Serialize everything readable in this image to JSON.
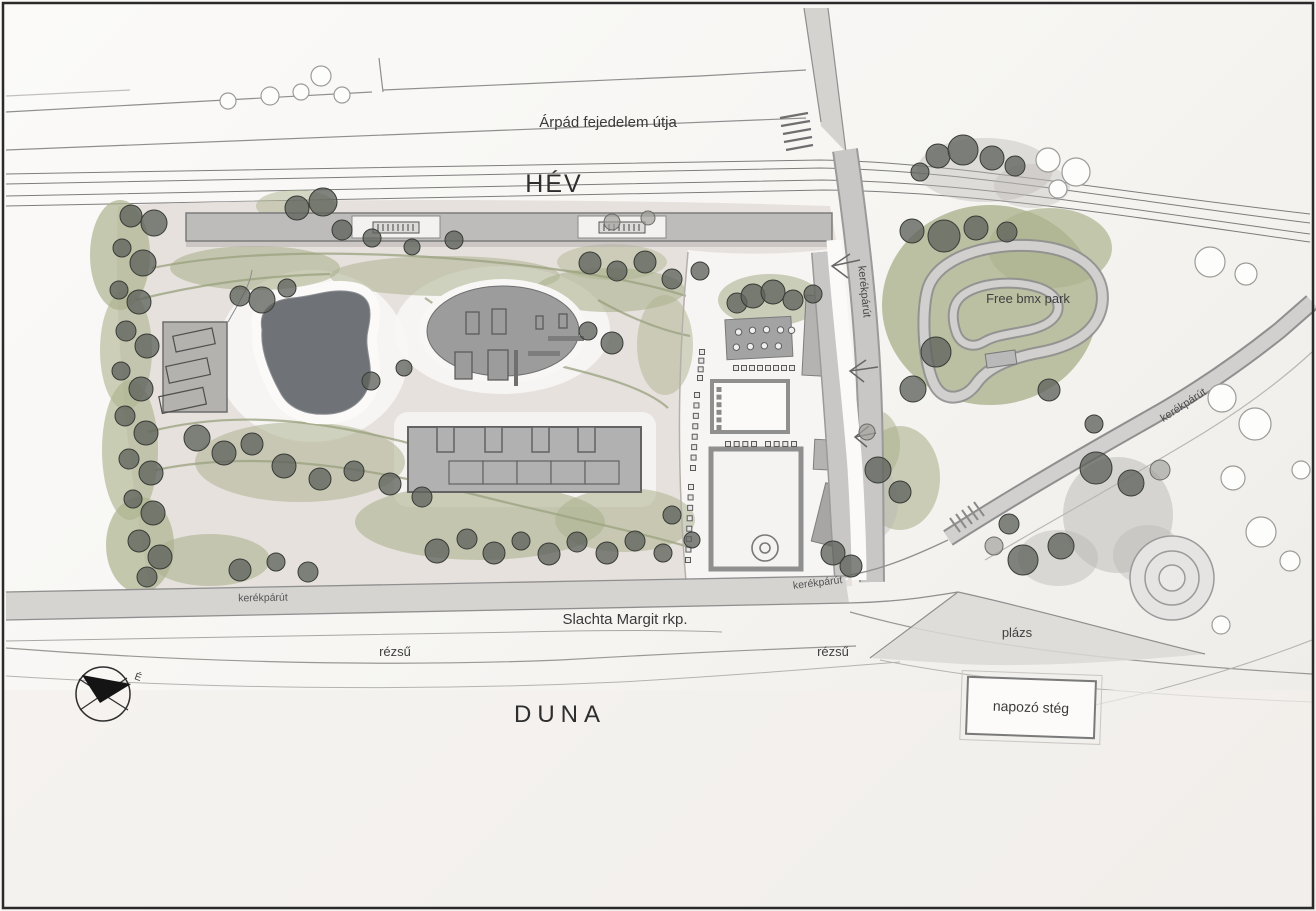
{
  "map": {
    "top": {
      "street": "Árpád fejedelem útja",
      "railway": "HÉV"
    },
    "park": {
      "bmx": "Free bmx park"
    },
    "paths": {
      "bike_vertical": "kerékpárút",
      "bike_diagonal": "kerékpárút",
      "bike_quay_left": "kerékpárút",
      "bike_quay_mid": "kerékpárút"
    },
    "waterfront": {
      "quay": "Slachta Margit rkp.",
      "embankment_left": "rézsű",
      "embankment_right": "rézsű",
      "beach": "plázs",
      "sun_deck": "napozó stég",
      "river": "DUNA"
    },
    "compass": {
      "north": "É"
    }
  },
  "colors": {
    "paper": "#f8f7f4",
    "ink": "#3a3a3a",
    "road_edge": "#8f8f8f",
    "building_gray": "#b3b2b0",
    "platform_gray": "#bdbcba",
    "pond_gray": "#6f7276",
    "vegetation_green": "#adb38f",
    "ground_beige": "#e3ddd8",
    "tree_gray": "#5f635c"
  }
}
